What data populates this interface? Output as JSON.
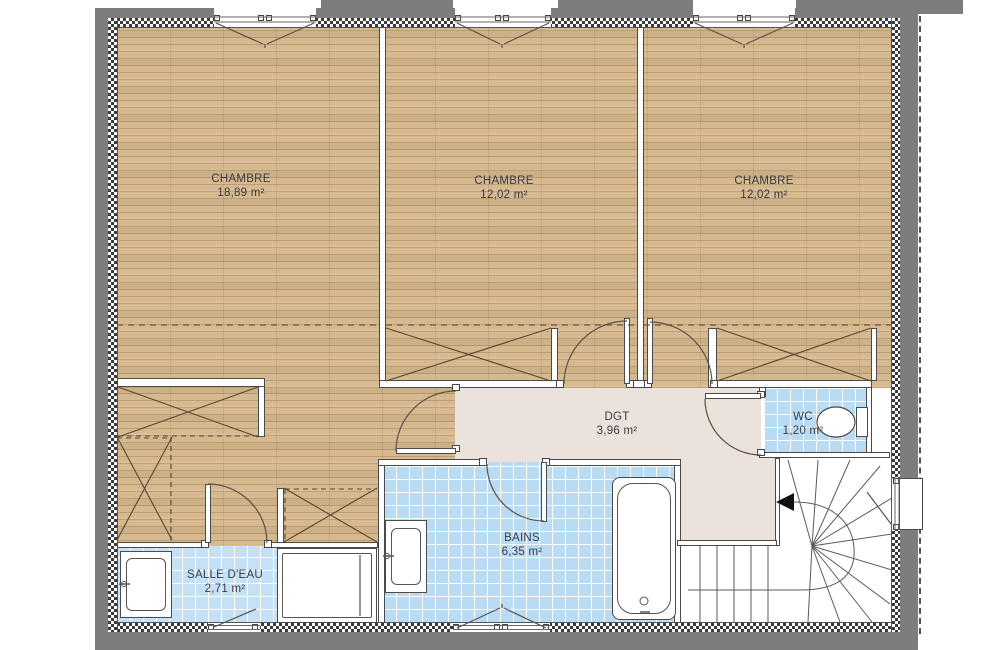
{
  "rooms": [
    {
      "id": "chambre-1",
      "label": "CHAMBRE",
      "area": "18,89 m²"
    },
    {
      "id": "chambre-2",
      "label": "CHAMBRE",
      "area": "12,02 m²"
    },
    {
      "id": "chambre-3",
      "label": "CHAMBRE",
      "area": "12,02 m²"
    },
    {
      "id": "dgt",
      "label": "DGT",
      "area": "3,96 m²"
    },
    {
      "id": "wc",
      "label": "WC",
      "area": "1,20 m²"
    },
    {
      "id": "bains",
      "label": "BAINS",
      "area": "6,35 m²"
    },
    {
      "id": "salle-deau",
      "label": "SALLE D'EAU",
      "area": "2,71 m²"
    }
  ],
  "colors": {
    "exterior_wall": "#7d7d7d",
    "wood_floor": "#d6b98f",
    "tile_floor": "#b9dbf3",
    "hall_floor": "#ece2dc",
    "label_text": "#3a3a45"
  }
}
